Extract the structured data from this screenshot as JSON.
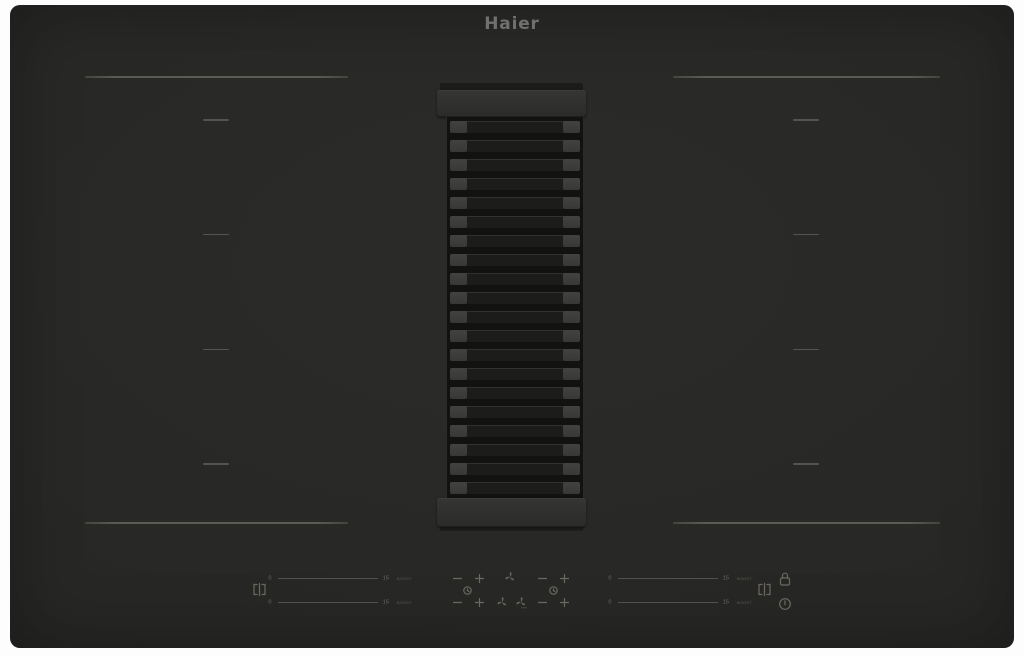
{
  "brand": {
    "logo": "Haier"
  },
  "colors": {
    "page_background": "#fdfdfd",
    "hob_surface": "#272725",
    "zone_marker": "#5c5a55",
    "logo_gray": "#707070",
    "control_gray": "#6b695f",
    "slat_cap": "#3e3e3c",
    "slat_body": "#1c1c1a",
    "grille_frame": "#121210",
    "vent_cap": "#2f2f2d"
  },
  "zones": {
    "dash_count": 4
  },
  "extractor": {
    "slat_count": 20
  },
  "controls": {
    "minus_label": "minus",
    "plus_label": "plus",
    "heat_sliders": [
      {
        "position": "left-rear",
        "min": "0",
        "max": "15",
        "boost": "BOOST"
      },
      {
        "position": "left-front",
        "min": "0",
        "max": "15",
        "boost": "BOOST"
      },
      {
        "position": "right-rear",
        "min": "0",
        "max": "15",
        "boost": "BOOST"
      },
      {
        "position": "right-front",
        "min": "0",
        "max": "15",
        "boost": "BOOST"
      }
    ],
    "icons": {
      "bridge_left": "bridge-zones-icon",
      "bridge_right": "bridge-zones-icon",
      "timer": "timer-icon",
      "hood_fan": "fan-icon",
      "hood_fan_max": "fan-max-icon",
      "lock": "child-lock-icon",
      "power": "power-icon"
    }
  }
}
